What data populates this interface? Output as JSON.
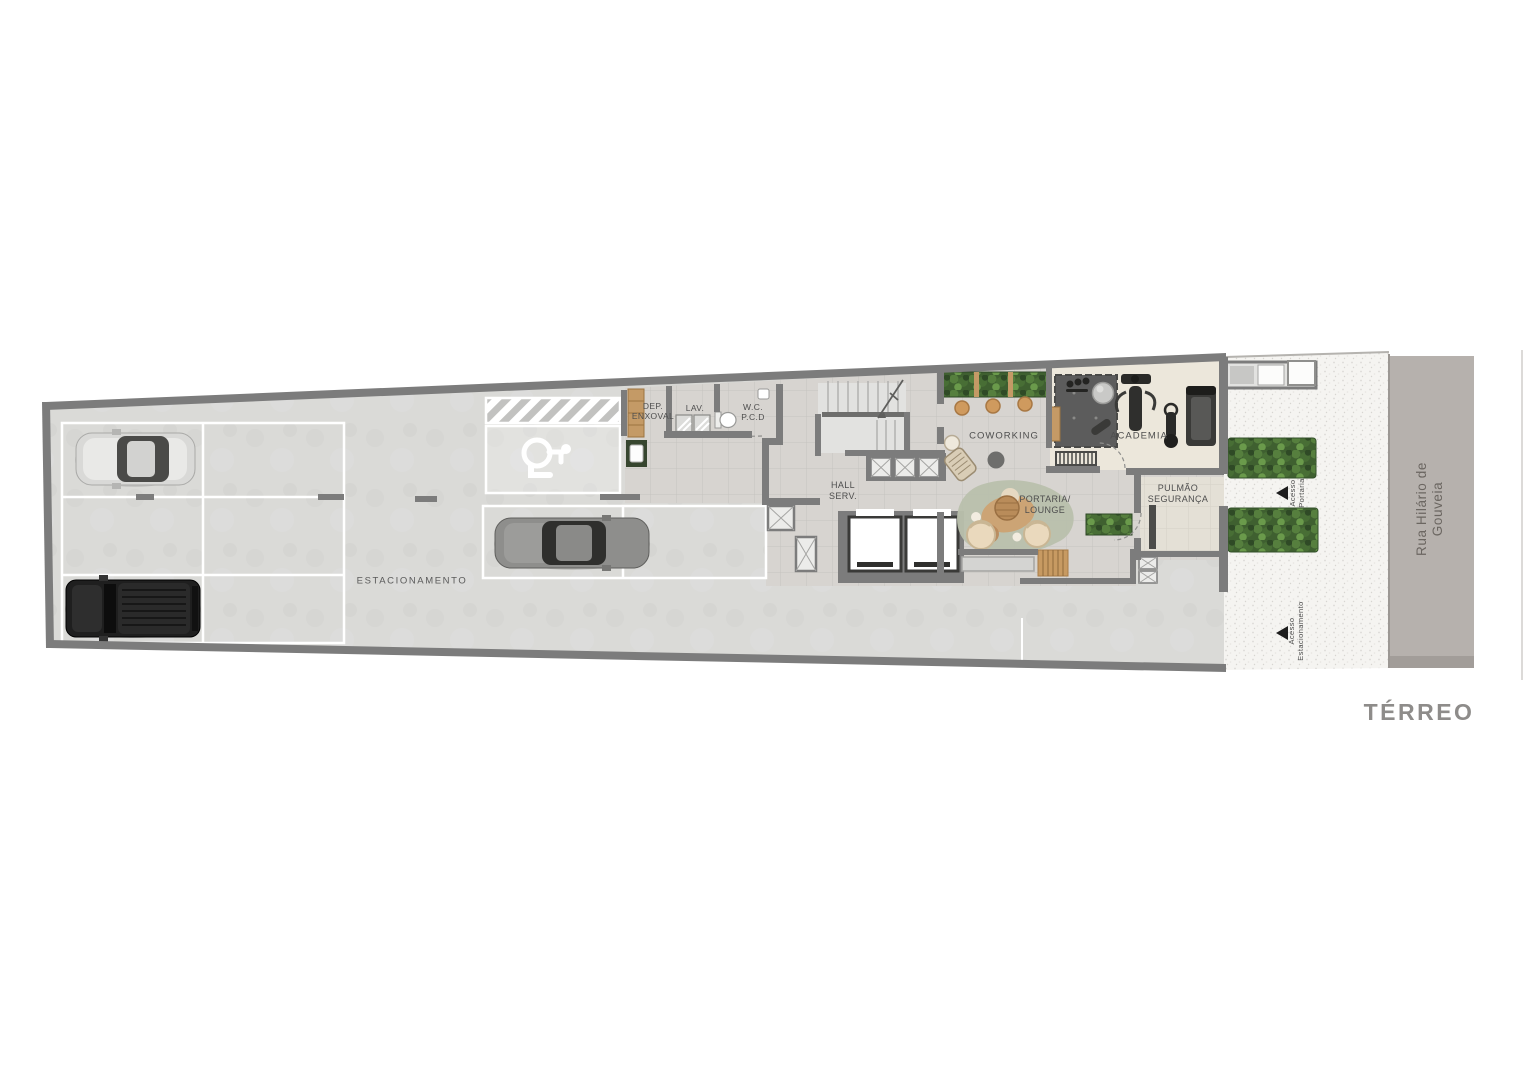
{
  "floor_plan": {
    "title": "TÉRREO",
    "street_name": "Rua Hilário de Gouveia",
    "areas": {
      "estacionamento": "ESTACIONAMENTO",
      "dep_enxoval": "DEP.\nENXOVAL",
      "lav": "LAV.",
      "wc_pcd": "W.C.\nP.C.D",
      "hall_serv": "HALL\nSERV.",
      "coworking": "COWORKING",
      "academia": "ACADEMIA",
      "portaria_lounge": "PORTARIA/\nLOUNGE",
      "pulmao_seguranca": "PULMÃO\nSEGURANÇA"
    },
    "access": {
      "portaria": "Acesso\nPortaria",
      "estacionamento": "Acesso\nEstacionamento"
    },
    "icons": {
      "accessible_parking": "wheelchair-icon",
      "access_direction": "triangle-left-icon"
    },
    "colors": {
      "wall": "#7c7c7c",
      "parking_floor": "#dadad8",
      "tile_floor": "#d7d4d0",
      "academia_floor": "#ece7db",
      "pulmao_floor": "#e4e0d6",
      "sidewalk": "#f5f4f1",
      "street": "#b6b1ad",
      "hedge_green": "#4e7a3a",
      "wood": "#c49a66",
      "gym_mat": "#5c5c5c",
      "lounge_rug": "#b9c0ac",
      "parking_marking": "#ffffff",
      "label_text": "#4e4e4e",
      "title_text": "#8e8c8a"
    }
  }
}
